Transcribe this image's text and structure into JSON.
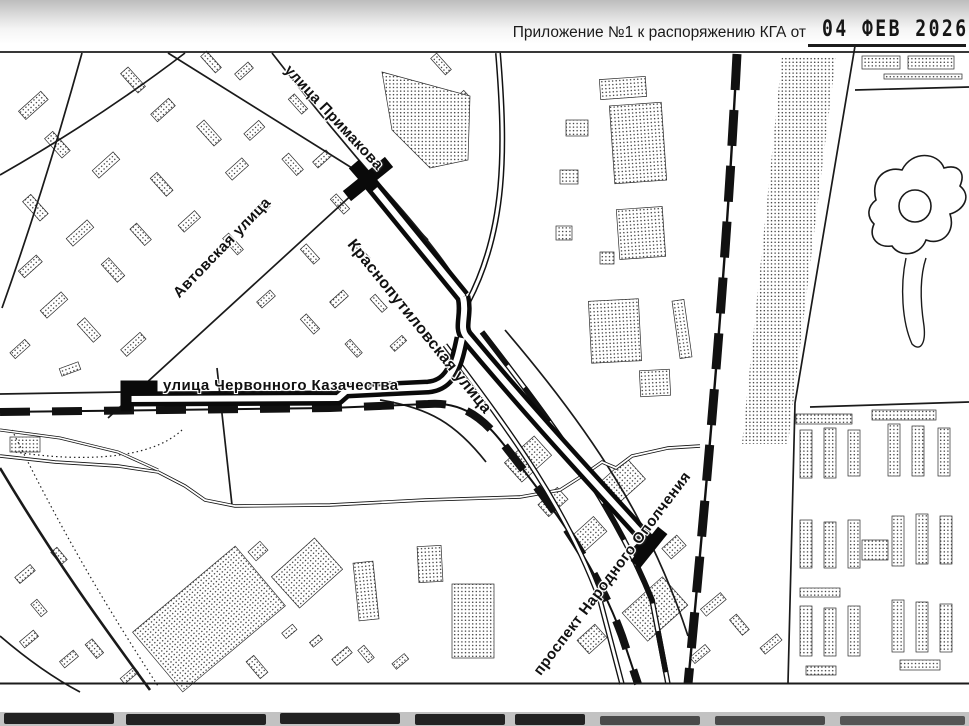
{
  "header": {
    "label": "Приложение №1 к распоряжению КГА от",
    "date_stamp": "04 ФЕВ 2026"
  },
  "map": {
    "street_labels": [
      {
        "id": "ulitsa-primakova",
        "text": "улица Примакова",
        "x": 287,
        "y": 66,
        "rotate": 47,
        "size": 15
      },
      {
        "id": "avtovskaya-ulitsa",
        "text": "Автовская улица",
        "x": 176,
        "y": 294,
        "rotate": -46,
        "size": 15
      },
      {
        "id": "krasnoputilovskaya-ulitsa",
        "text": "Краснопутиловская улица",
        "x": 350,
        "y": 241,
        "rotate": 51,
        "size": 16
      },
      {
        "id": "ulitsa-chervonnogo-kazachestva",
        "text": "улица Червонного Казачества",
        "x": 163,
        "y": 384,
        "rotate": 0,
        "size": 15
      },
      {
        "id": "prospekt-narodnogo-opolcheniya",
        "text": "проспект Народного Ополчения",
        "x": 537,
        "y": 672,
        "rotate": -53,
        "size": 15
      }
    ],
    "ink_color": "#111111",
    "paper_color": "#ffffff"
  }
}
